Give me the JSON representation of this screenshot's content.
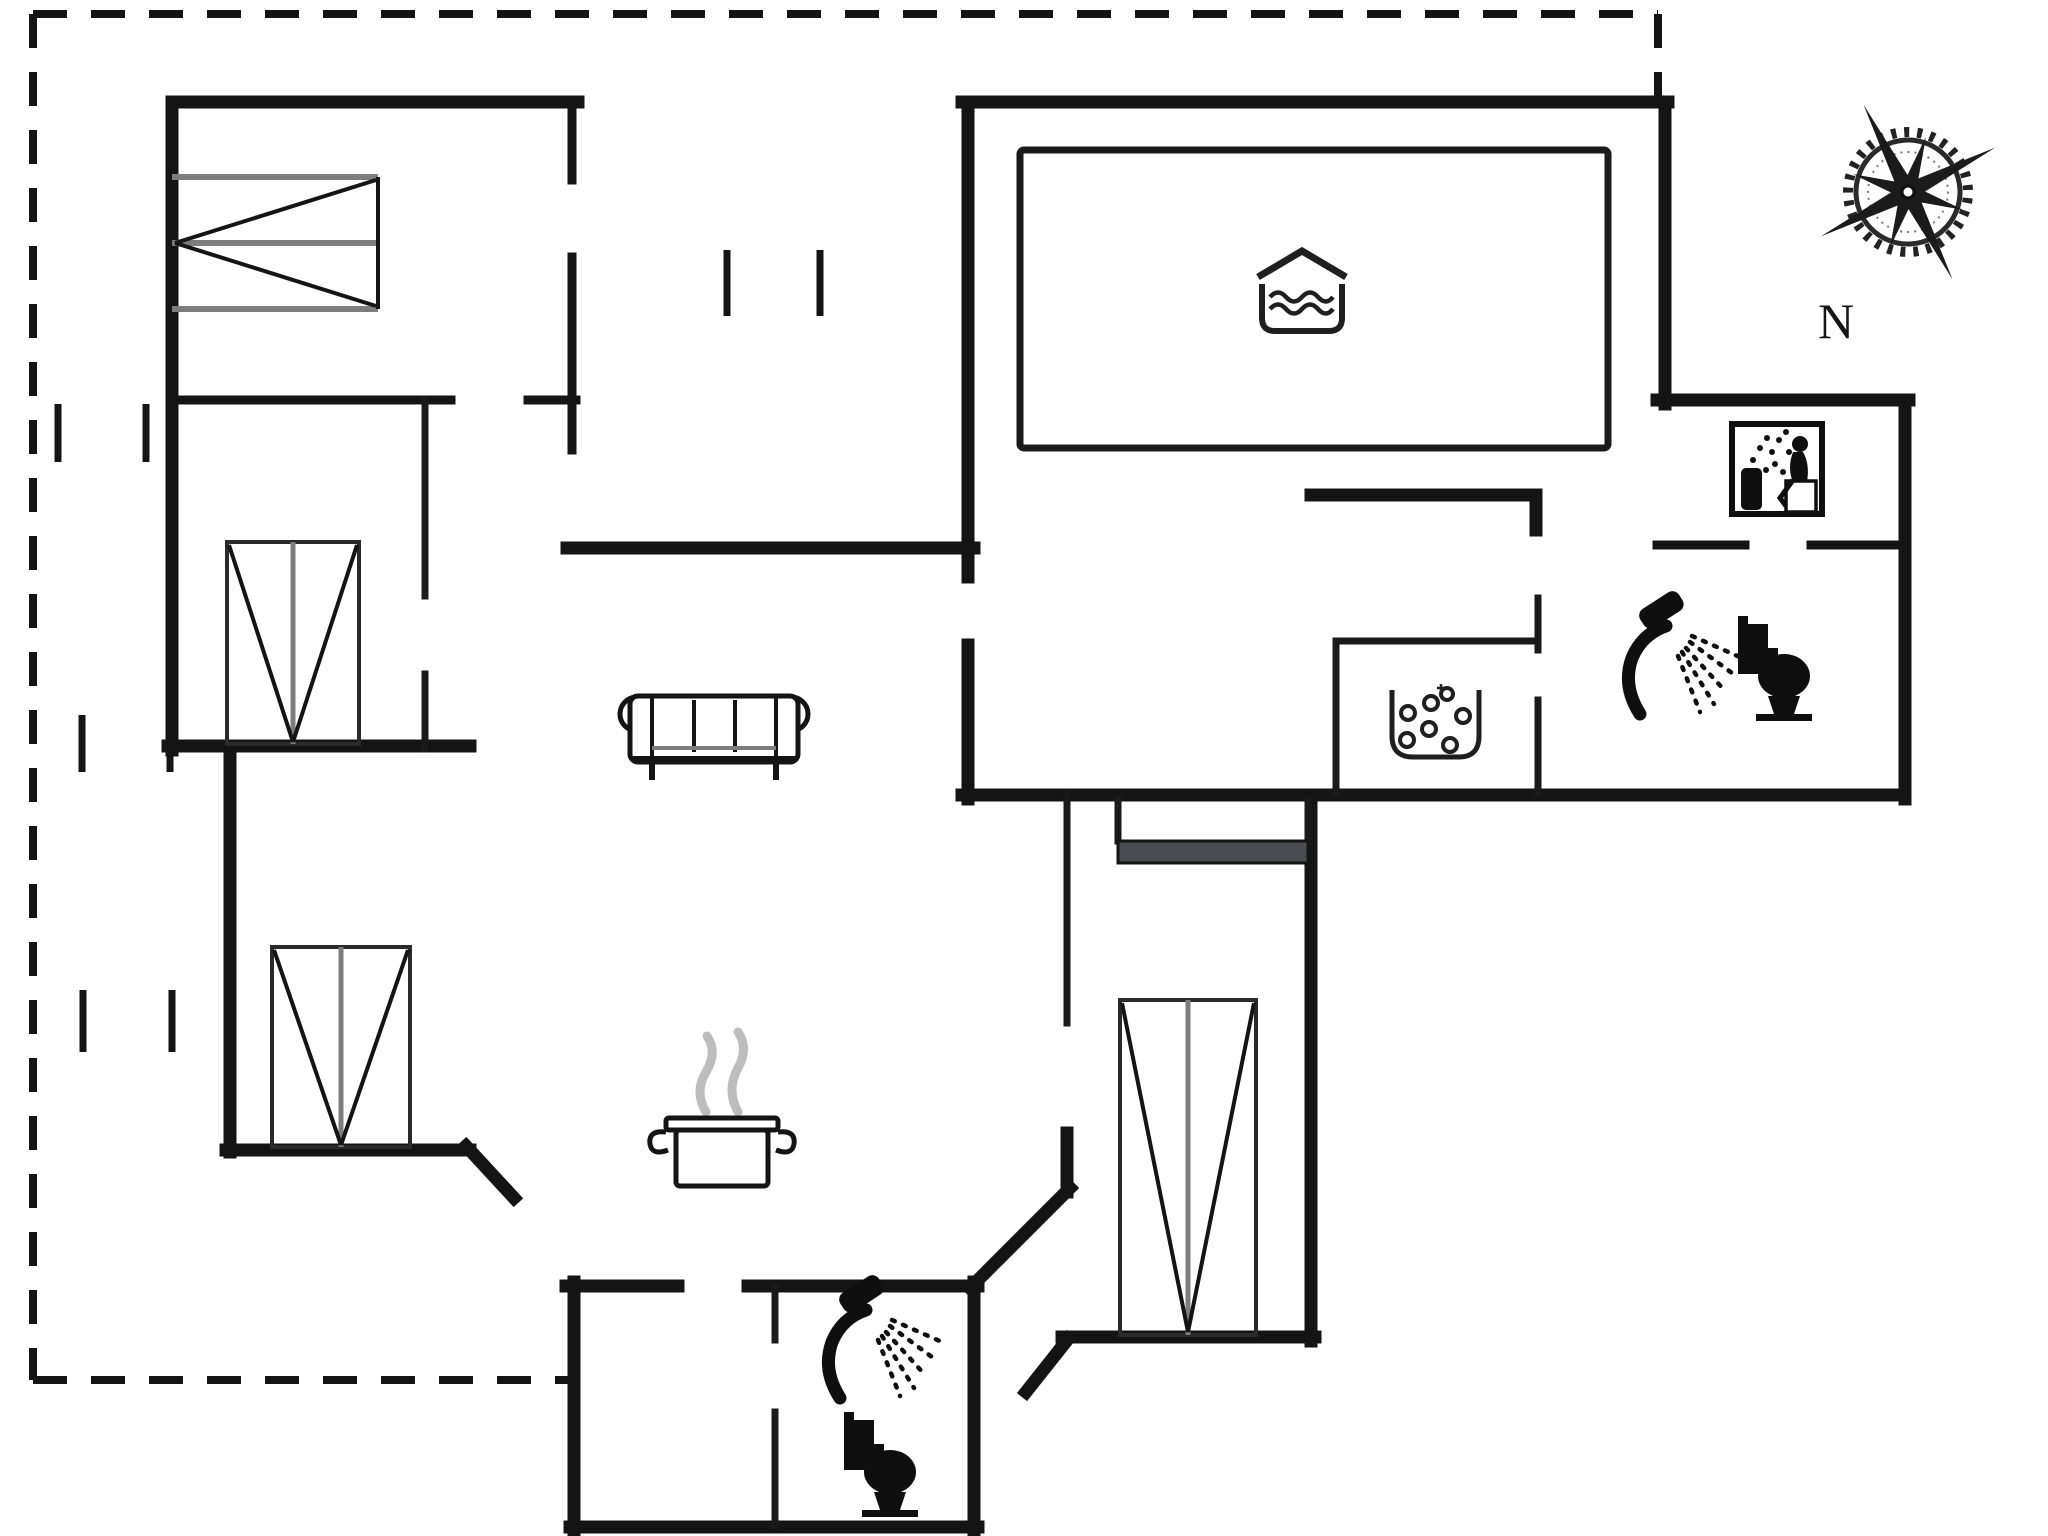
{
  "document": {
    "type": "floor-plan",
    "style": "black-and-white architectural plan",
    "background_color": "#ffffff",
    "wall_color": "#141414",
    "bed_line_color": "#7d7d7d",
    "steam_color": "#bdbdbd",
    "counter_color": "#4b4b52",
    "terrace_boundary_style": "dashed"
  },
  "compass": {
    "label": "N",
    "type": "compass-rose",
    "position": "top-right"
  },
  "rooms": [
    {
      "name": "bedroom-1",
      "furniture": [
        "double-bed-horizontal"
      ]
    },
    {
      "name": "bedroom-2",
      "furniture": [
        "double-bed-vertical"
      ]
    },
    {
      "name": "bedroom-3",
      "furniture": [
        "double-bed-vertical"
      ]
    },
    {
      "name": "bedroom-4",
      "furniture": [
        "double-bed-vertical",
        "counter-bar"
      ]
    },
    {
      "name": "living-room",
      "furniture": [
        "sofa"
      ]
    },
    {
      "name": "kitchen",
      "icons": [
        "steaming-pot-icon"
      ]
    },
    {
      "name": "pool-room",
      "icons": [
        "indoor-pool-icon"
      ],
      "features": [
        "pool-basin"
      ]
    },
    {
      "name": "sauna-room",
      "icons": [
        "sauna-stones-icon"
      ]
    },
    {
      "name": "spa-room",
      "icons": [
        "whirlpool-spa-icon"
      ]
    },
    {
      "name": "bathroom-main",
      "icons": [
        "shower-icon",
        "toilet-icon"
      ]
    },
    {
      "name": "bathroom-annex",
      "icons": [
        "shower-icon",
        "toilet-icon"
      ]
    },
    {
      "name": "terrace",
      "features": [
        "dashed-boundary",
        "window-tick-marks"
      ]
    }
  ],
  "icon_legend": [
    {
      "icon": "indoor-pool-icon",
      "meaning": "swimming pool"
    },
    {
      "icon": "whirlpool-spa-icon",
      "meaning": "whirlpool / spa bath"
    },
    {
      "icon": "sauna-stones-icon",
      "meaning": "sauna stones"
    },
    {
      "icon": "shower-icon",
      "meaning": "shower"
    },
    {
      "icon": "toilet-icon",
      "meaning": "WC"
    },
    {
      "icon": "steaming-pot-icon",
      "meaning": "kitchen / stove"
    }
  ],
  "counts": {
    "beds": 4,
    "sofas": 1,
    "showers": 2,
    "toilets": 2,
    "window_tick_pairs": 4
  }
}
